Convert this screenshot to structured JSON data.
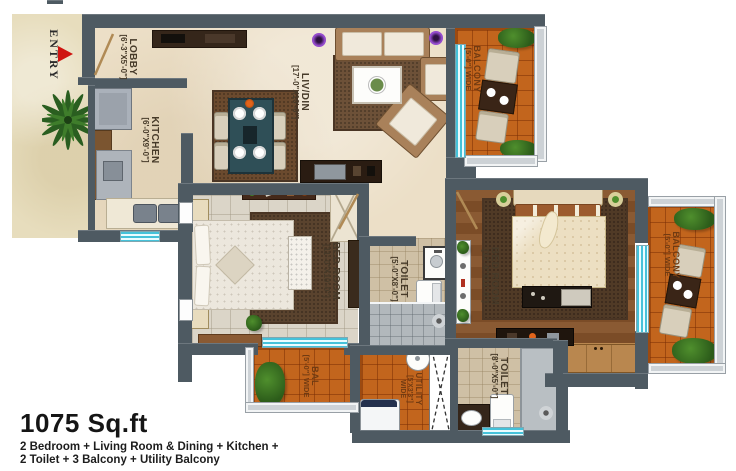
{
  "title": {
    "area": "1075 Sq.ft",
    "line1": "2 Bedroom + Living Room & Dining + Kitchen +",
    "line2": "2 Toilet + 3 Balcony + Utility Balcony"
  },
  "entry": {
    "label": "ENTRY"
  },
  "rooms": {
    "lobby": {
      "name": "LOBBY",
      "dim": "[6'-3\"X5'-0\"]"
    },
    "kitchen": {
      "name": "KITCHEN",
      "dim": "[6'-0\"X9'-0\"]"
    },
    "livdin": {
      "name": "LIV/DIN",
      "dim": "[17'-0\"X10'-0\"]"
    },
    "bedroom_left": {
      "name": "BED ROOM",
      "dim": "[11'-0\"X10'-0\"]"
    },
    "bedroom_right": {
      "name": "BED ROOM",
      "dim": "[12'-0\"X11'-0\"]"
    },
    "toilet_middle": {
      "name": "TOILET",
      "dim": "[5'-0\"X8'-0\"]"
    },
    "toilet_bottom": {
      "name": "TOILET",
      "dim": "[8'-0\"X5'-0\"]"
    },
    "balcony_top": {
      "name": "BALCONY",
      "dim": "[5'-0\"] WIDE"
    },
    "balcony_right": {
      "name": "BALCONY",
      "dim": "[5'-0\"] WIDE"
    },
    "balcony_bottom": {
      "name": "BAL",
      "dim": "[5'-0\"] WIDE"
    },
    "utility": {
      "name": "UTILITY",
      "dim": "[5'X3'3\"]",
      "extra": "WIDE"
    }
  },
  "colors": {
    "wall": "#4e5a62",
    "floor": "#ecdfc7",
    "tile_floor": "#dbd5c8",
    "wood_floor": "#84552c",
    "balcony_tile": "#c2651d",
    "glass": "#49c4dd",
    "label": "#463a29",
    "balcony_label": "#713b12",
    "entry_arrow": "#cf1410"
  }
}
